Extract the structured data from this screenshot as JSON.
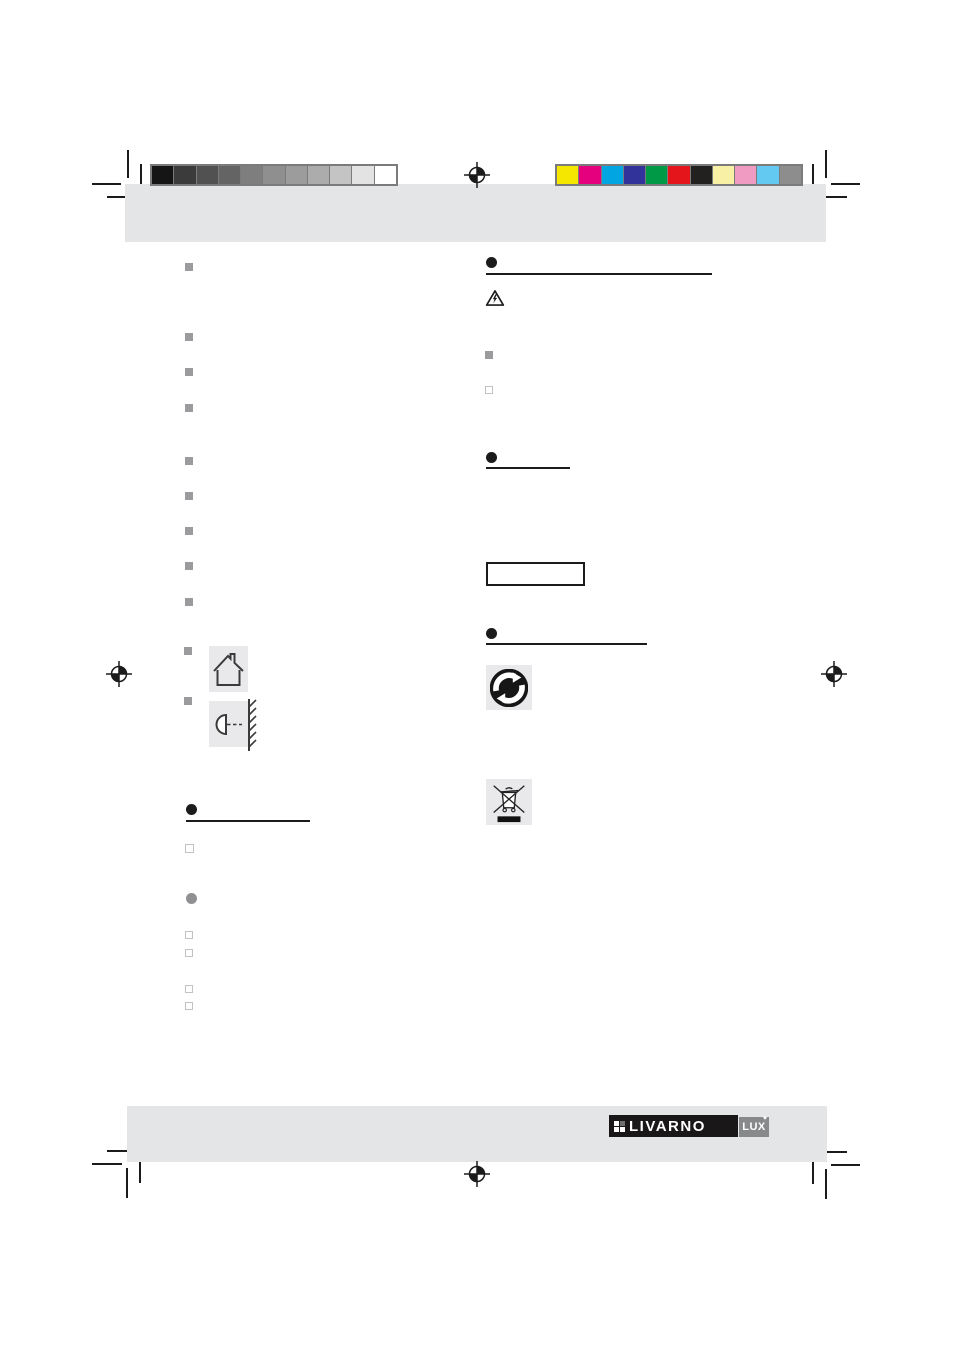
{
  "page": {
    "background": "#ffffff",
    "band_color": "#e4e5e7",
    "icon_box_color": "#e9e9eb",
    "ink_color": "#1b1b1b"
  },
  "print_marks": {
    "grayscale_bar": {
      "swatches": [
        "#151515",
        "#3b3b3b",
        "#515151",
        "#646464",
        "#7e7e7e",
        "#8f8f8f",
        "#9c9c9c",
        "#acacac",
        "#c4c4c4",
        "#e3e3e3",
        "#ffffff"
      ]
    },
    "color_bar": {
      "swatches": [
        "#f6e700",
        "#e5007d",
        "#00a5e2",
        "#32329b",
        "#009a47",
        "#e5161b",
        "#232020",
        "#f7f0a5",
        "#f09cc2",
        "#63c9f1",
        "#8d8d8d"
      ]
    }
  },
  "branding": {
    "logo_text": "LIVARNO",
    "logo_sub": "LUX",
    "logo_star": "✦"
  },
  "icons": {
    "house": "house-indoor-use-icon",
    "wall_lamp": "wall-mounted-lamp-icon",
    "warning": "electrical-hazard-warning-icon",
    "green_dot": "green-dot-recycling-icon",
    "weee": "crossed-out-wheelie-bin-icon",
    "registration": "registration-mark-icon"
  }
}
